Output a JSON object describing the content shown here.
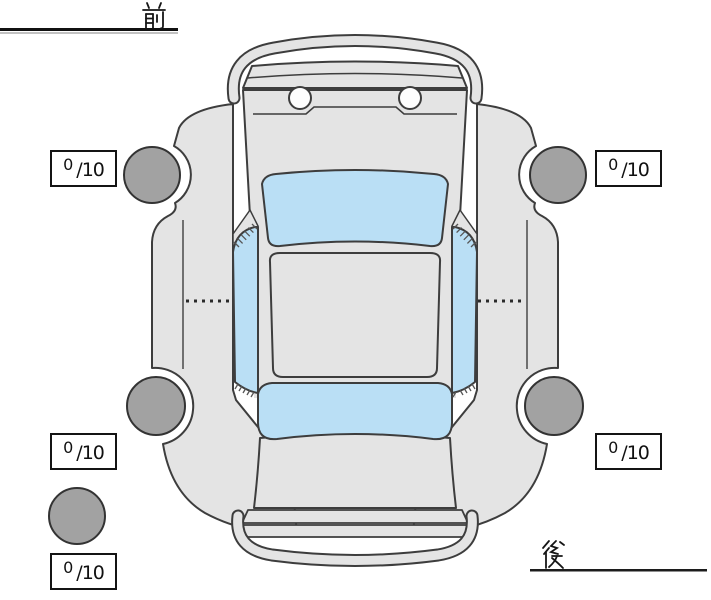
{
  "labels": {
    "front": "前",
    "rear": "後"
  },
  "scores": {
    "front_left": {
      "value": "0",
      "denominator": "/10"
    },
    "front_right": {
      "value": "0",
      "denominator": "/10"
    },
    "rear_left": {
      "value": "0",
      "denominator": "/10"
    },
    "rear_right": {
      "value": "0",
      "denominator": "/10"
    },
    "spare": {
      "value": "0",
      "denominator": "/10"
    }
  },
  "colors": {
    "body": "#e4e4e4",
    "window": "#badff5",
    "tire": "#a2a2a2",
    "outline": "#3d3d3d"
  }
}
